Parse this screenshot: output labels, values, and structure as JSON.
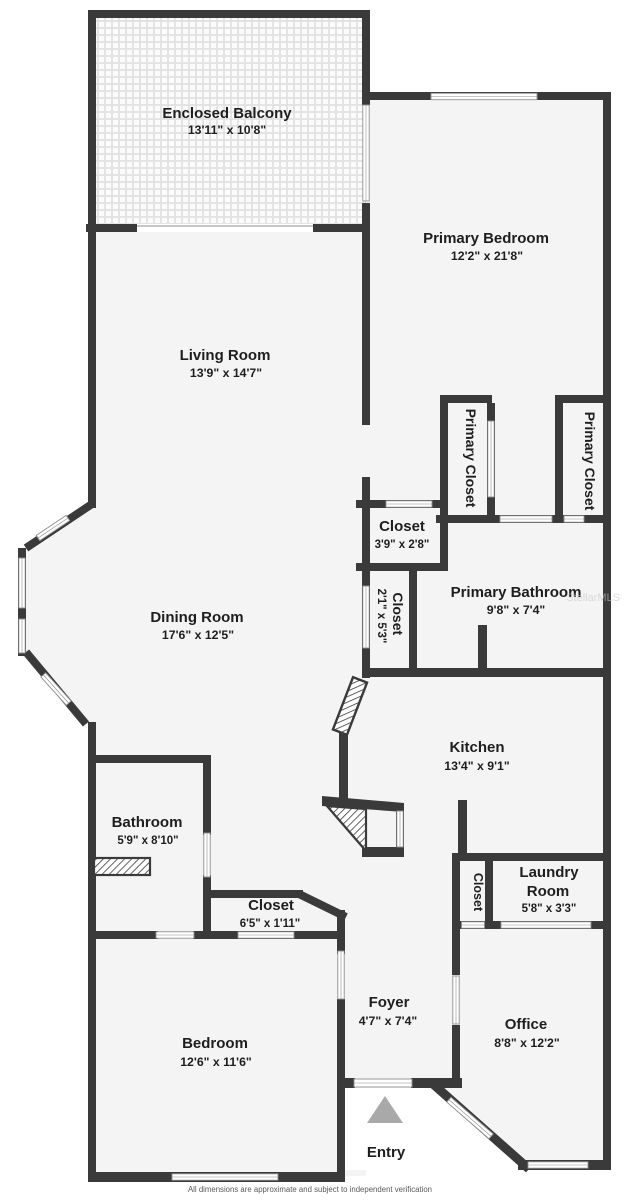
{
  "meta": {
    "footer": "All dimensions are approximate and subject to independent verification",
    "watermark": "StellarMLS"
  },
  "colors": {
    "wall": "#3a3a3a",
    "floor": "#f4f4f4",
    "entry_arrow": "#a9a9a9"
  },
  "rooms": {
    "enclosed_balcony": {
      "label": "Enclosed Balcony",
      "dims": "13'11\" x 10'8\""
    },
    "primary_bedroom": {
      "label": "Primary Bedroom",
      "dims": "12'2\" x 21'8\""
    },
    "living_room": {
      "label": "Living Room",
      "dims": "13'9\" x 14'7\""
    },
    "dining_room": {
      "label": "Dining Room",
      "dims": "17'6\" x 12'5\""
    },
    "primary_closet_left": {
      "label": "Primary Closet"
    },
    "primary_closet_right": {
      "label": "Primary Closet"
    },
    "closet_3x2": {
      "label": "Closet",
      "dims": "3'9\" x 2'8\""
    },
    "closet_2x5": {
      "label": "Closet",
      "dims": "2'1\" x 5'3\""
    },
    "primary_bathroom": {
      "label": "Primary Bathroom",
      "dims": "9'8\" x 7'4\""
    },
    "kitchen": {
      "label": "Kitchen",
      "dims": "13'4\" x 9'1\""
    },
    "bathroom": {
      "label": "Bathroom",
      "dims": "5'9\" x 8'10\""
    },
    "hall_closet": {
      "label": "Closet",
      "dims": "6'5\" x 1'11\""
    },
    "laundry_room": {
      "label_line1": "Laundry",
      "label_line2": "Room",
      "dims": "5'8\" x 3'3\""
    },
    "laundry_closet": {
      "label": "Closet"
    },
    "bedroom": {
      "label": "Bedroom",
      "dims": "12'6\" x 11'6\""
    },
    "foyer": {
      "label": "Foyer",
      "dims": "4'7\" x 7'4\""
    },
    "office": {
      "label": "Office",
      "dims": "8'8\" x 12'2\""
    },
    "entry": {
      "label": "Entry"
    }
  }
}
